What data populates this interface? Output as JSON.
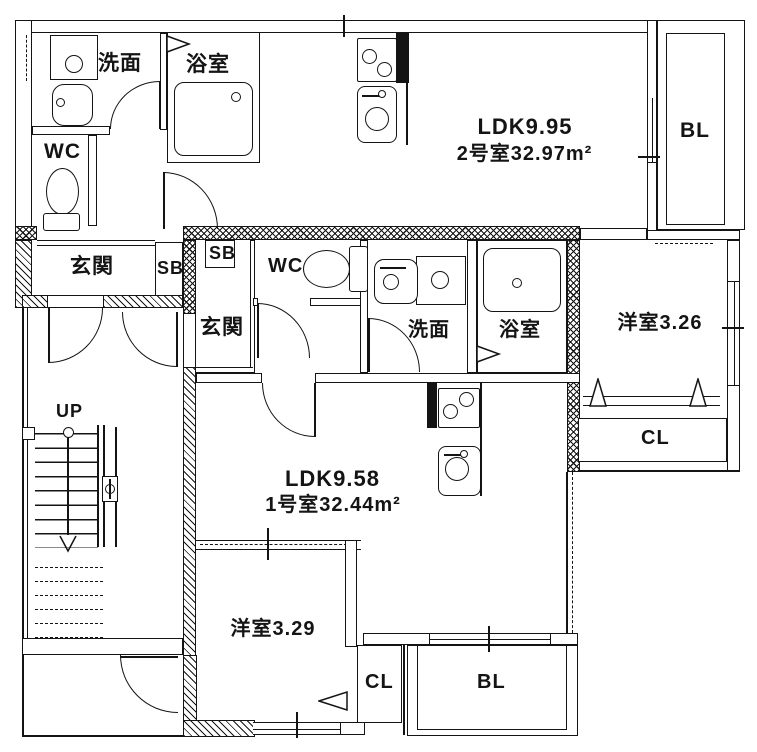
{
  "plan": {
    "unit2": {
      "name_line1": "LDK9.95",
      "name_line2": "2号室32.97m²",
      "washroom": "洗面",
      "bathroom": "浴室",
      "toilet": "WC",
      "entrance": "玄関",
      "shoe_box": "SB",
      "balcony": "BL"
    },
    "unit1": {
      "name_line1": "LDK9.58",
      "name_line2": "1号室32.44m²",
      "washroom": "洗面",
      "bathroom": "浴室",
      "toilet": "WC",
      "entrance": "玄関",
      "shoe_box": "SB",
      "bedroom_east": "洋室3.26",
      "bedroom_east_closet": "CL",
      "bedroom_south": "洋室3.29",
      "bedroom_south_closet": "CL",
      "balcony_east": "BL",
      "balcony_south": "BL"
    },
    "common": {
      "stairs": "UP"
    }
  }
}
